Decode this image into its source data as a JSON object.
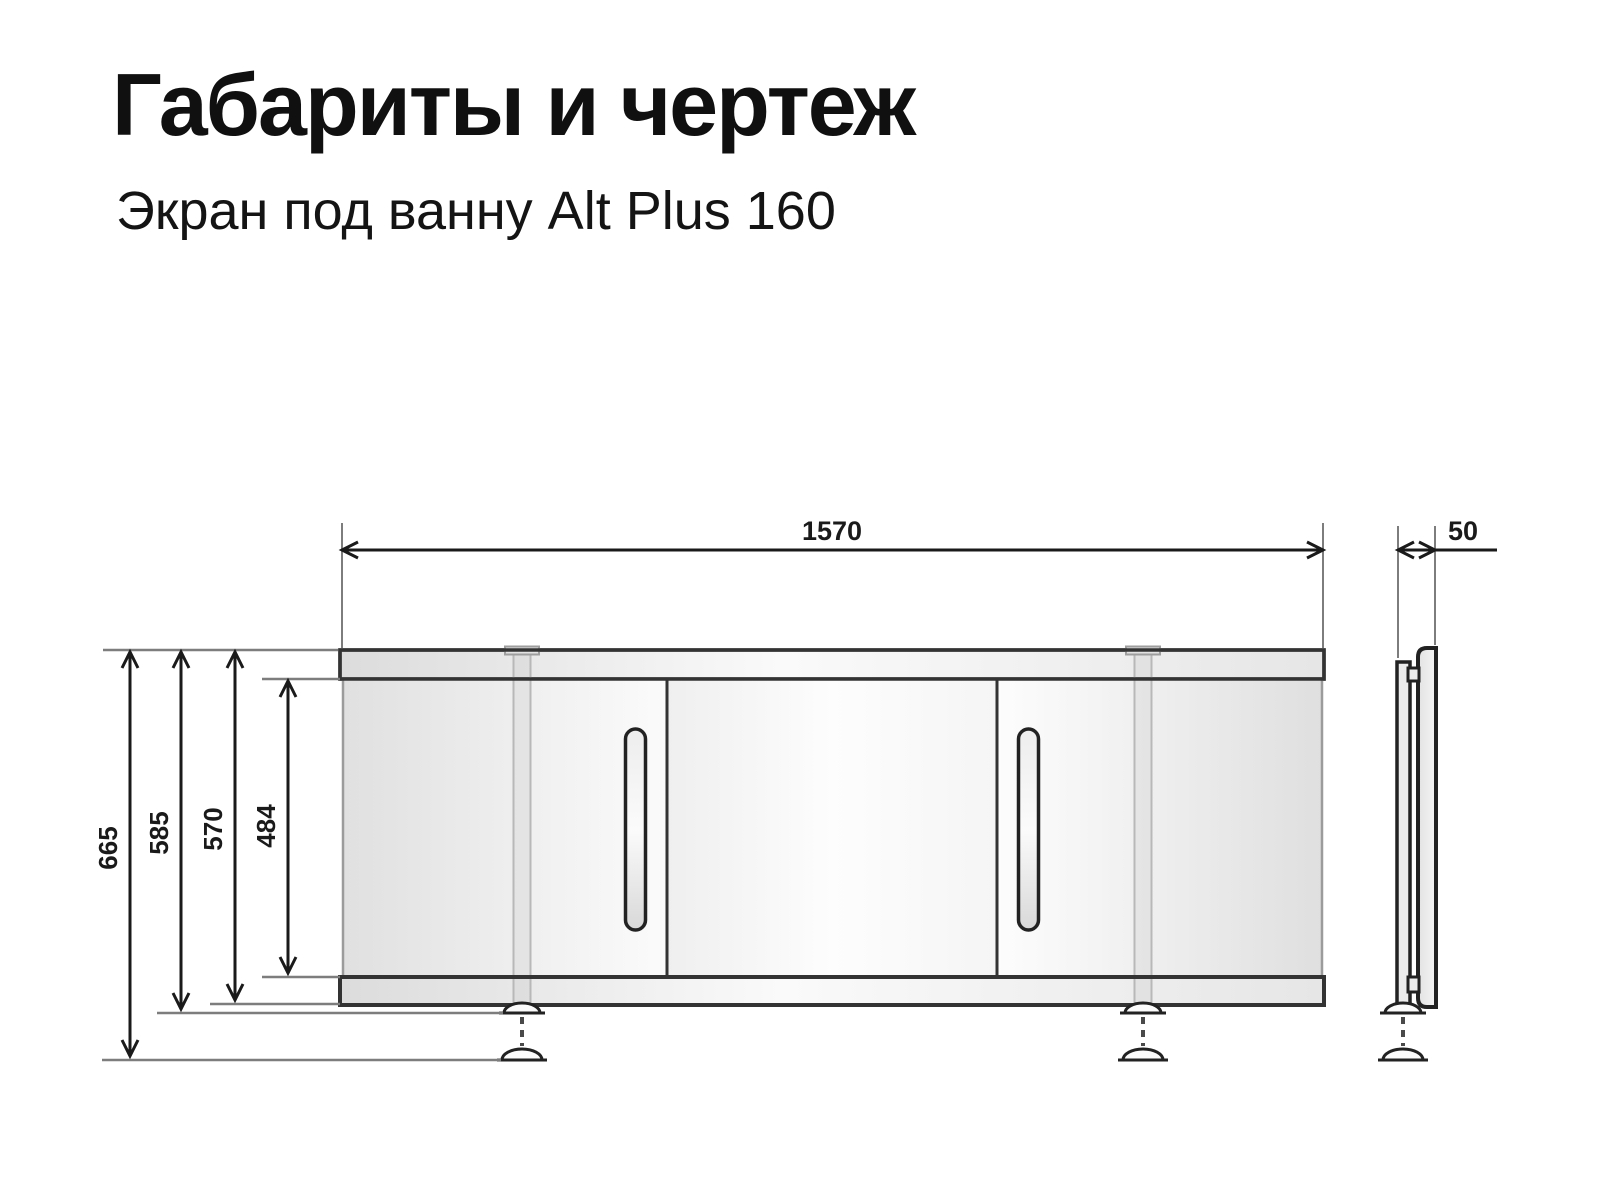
{
  "header": {
    "title": "Габариты и чертеж",
    "subtitle": "Экран под ванну Alt Plus 160"
  },
  "drawing": {
    "dimensions": {
      "width_mm": "1570",
      "depth_mm": "50",
      "height_total_mm": "665",
      "height_feet_retracted_mm": "585",
      "height_panel_mm": "570",
      "height_opening_mm": "484"
    },
    "colors": {
      "outline_dark": "#2e2e2e",
      "dimension_black": "#1a1a1a",
      "reference_gray": "#7d7d7d",
      "panel_fill_light": "#ececec",
      "background": "#ffffff"
    }
  }
}
